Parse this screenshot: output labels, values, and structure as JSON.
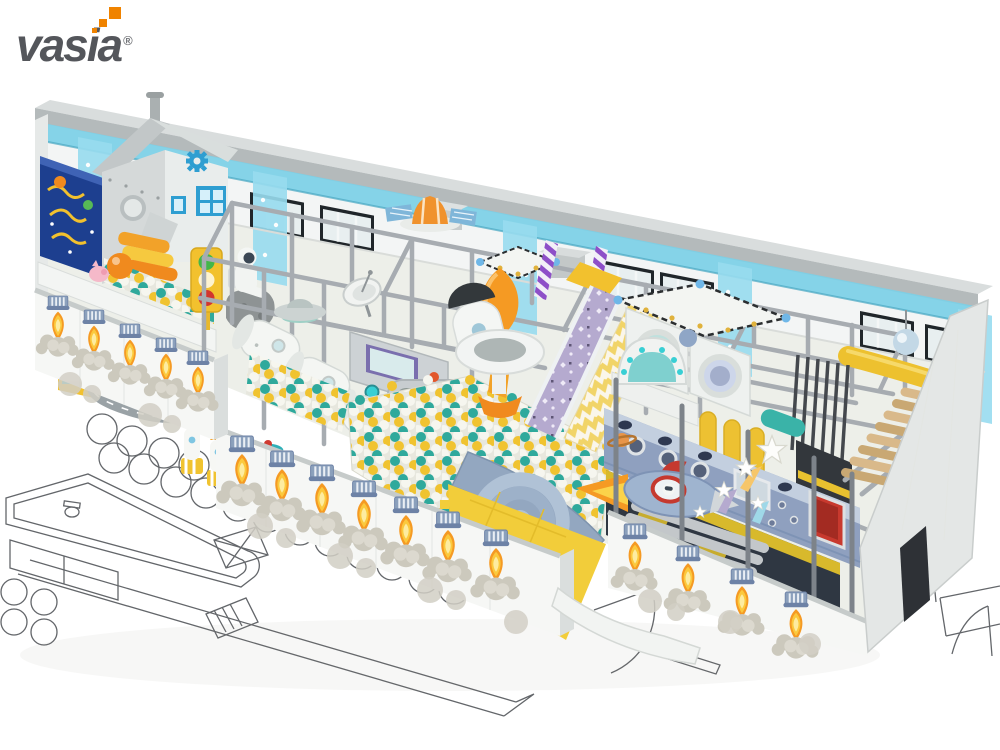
{
  "brand": {
    "logo_text": "vasia",
    "registered_mark": "®"
  },
  "image": {
    "type": "3d-product-render",
    "subject": "space-themed indoor playground equipment shown in cutaway perspective over an architectural floor plan",
    "palette": {
      "logo_gray": "#54565b",
      "logo_orange": "#f08300",
      "steel_frame_gray": "#a7acb1",
      "wall_white": "#f4f6f5",
      "glass_strip_blue": "#7ccfe6",
      "banner_blue": "#98dcef",
      "ball_teal": "#2fa99c",
      "ball_yellow": "#f0c330",
      "ball_white": "#f6f6ef",
      "mat_yellow": "#f2cd3a",
      "flame_orange": "#f59a23",
      "nozzle_blue": "#8ba0bc",
      "spaceship_wall_blue": "#8fa0bf",
      "door_red": "#c8392e",
      "slide_purple": "#b5aacf",
      "wood_tan": "#d9b98a",
      "interior_dark": "#2f3742"
    },
    "features": [
      "space station house with gear and chimney",
      "dark blue interactive game wall",
      "toddler ball pool with giant orange ball",
      "traffic light toy",
      "astronaut figure on moon rock",
      "gray road track",
      "mini rocket seats",
      "spinner toy",
      "white space-capsule crawl tunnels",
      "control console with screen",
      "giant rounded display screen",
      "satellite dish",
      "ufo saucer",
      "giant ball pit with teal-yellow-white balls",
      "orange rocket capsule",
      "flying saucer ring platform",
      "purple sparkle slide",
      "yellow chevron climb mat",
      "porthole washing-machine panels",
      "striped circus canopies",
      "orange command module with solar panels",
      "astronaut helmet console",
      "yellow punching bags",
      "rocket ship ride with flame",
      "saturn planet decor",
      "gray log rollers",
      "shooting star decorations",
      "blue spaceship panel wall with portholes and red door",
      "wooden roller stairs",
      "black climbing frame with hazard stripes",
      "rocket flame printed outer walls",
      "architectural floor plan line drawing"
    ]
  }
}
